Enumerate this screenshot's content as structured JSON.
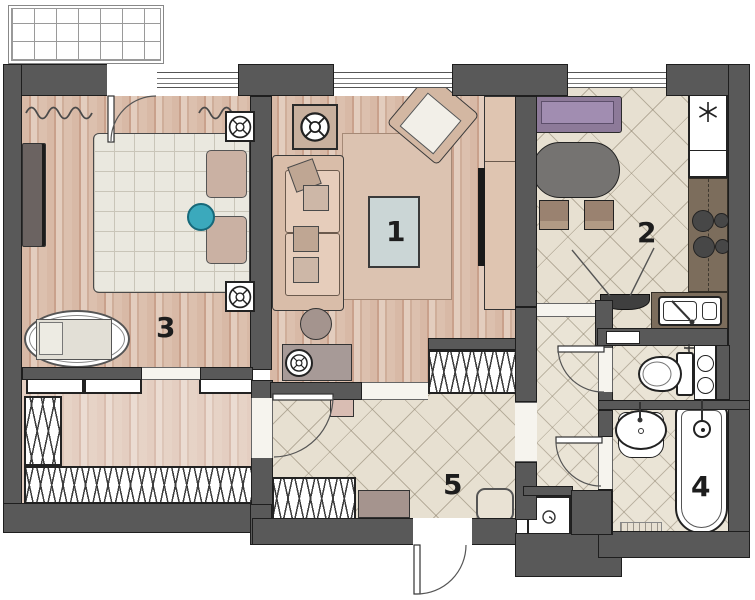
{
  "plan_title": "two-room apartment floor plan",
  "room_labels": [
    {
      "number": "1"
    },
    {
      "number": "2"
    },
    {
      "number": "3"
    },
    {
      "number": "4"
    },
    {
      "number": "5"
    }
  ],
  "icons": [
    {
      "name": "snowflake-icon",
      "meaning": "refrigerator"
    },
    {
      "name": "circle-cross-spot-icon",
      "meaning": "ceiling spot / speaker"
    },
    {
      "name": "spiral-icon",
      "meaning": "washing machine"
    },
    {
      "name": "hood-vent-icon",
      "meaning": "cooker hood"
    },
    {
      "name": "hatch-wardrobe-pattern",
      "meaning": "wardrobe / storage"
    }
  ],
  "colors": {
    "wall": "#595959",
    "wood_floor": "#d8b9a6",
    "tile_floor": "#e7e0d1",
    "accent_teal": "#3ba9bc",
    "accent_purple": "#8d7a99",
    "counter_brown": "#7c6d5c",
    "coffee_table_blue": "#cbd6d6"
  }
}
